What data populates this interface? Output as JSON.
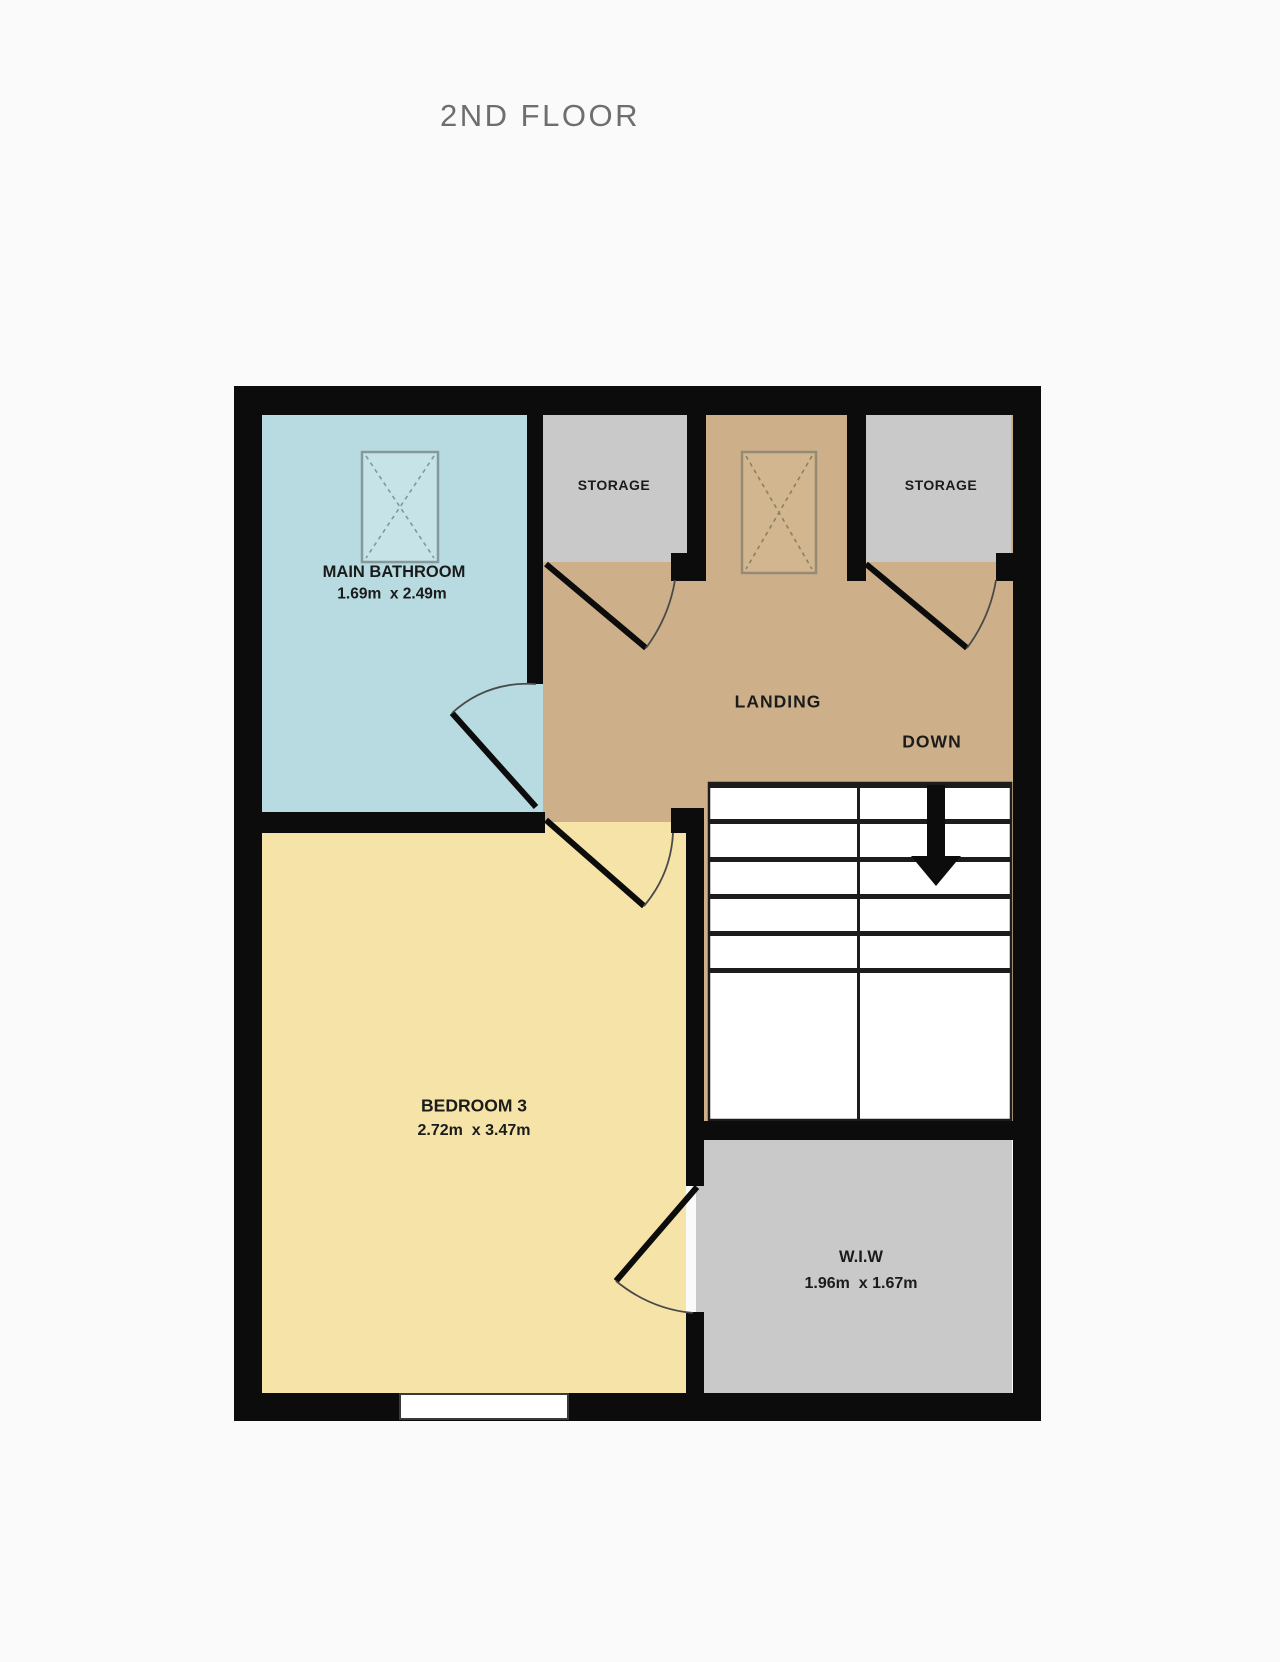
{
  "title": "2ND FLOOR",
  "colors": {
    "background": "#fafafa",
    "wall": "#0c0c0c",
    "bathroom_floor": "#b7dbe1",
    "bedroom_floor": "#f5e3a8",
    "landing_floor": "#cdb089",
    "storage_floor": "#c9c9c9",
    "wiw_floor": "#c9c9c9",
    "stairs_floor": "#ffffff",
    "stair_lines": "#1c1c1c",
    "title_text": "#6e6e6e",
    "label_text": "#1b1b1b"
  },
  "rooms": {
    "main_bathroom": {
      "name": "MAIN BATHROOM",
      "dims": "1.69m  x 2.49m"
    },
    "storage_left": {
      "name": "STORAGE"
    },
    "storage_right": {
      "name": "STORAGE"
    },
    "landing": {
      "name": "LANDING"
    },
    "stairs": {
      "direction_label": "DOWN"
    },
    "bedroom_3": {
      "name": "BEDROOM 3",
      "dims": "2.72m  x 3.47m"
    },
    "wiw": {
      "name": "W.I.W",
      "dims": "1.96m  x 1.67m"
    }
  }
}
